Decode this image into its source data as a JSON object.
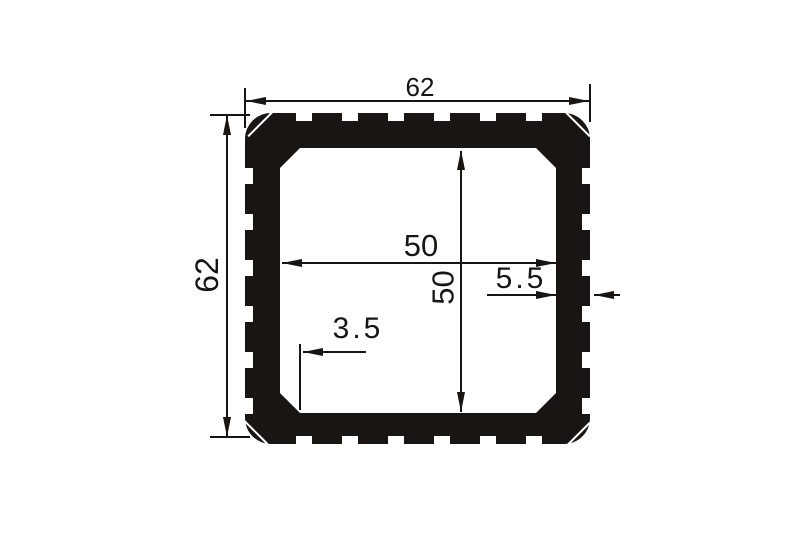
{
  "drawing": {
    "kind": "square-tube-extrusion-cross-section",
    "ink_color": "#181512",
    "background_color": "#ffffff",
    "dimensions": {
      "outer_width": "62",
      "outer_height": "62",
      "inner_width": "50",
      "inner_height": "50",
      "wall_thickness": "5.5",
      "inner_chamfer": "3.5"
    }
  }
}
